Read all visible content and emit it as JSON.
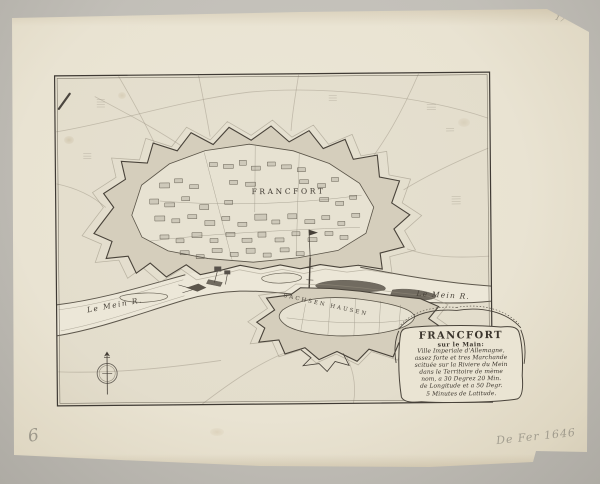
{
  "photo": {
    "backdrop_color": "#c2bfb8",
    "paper_color": "#e9e3d2",
    "ink_color": "#453f37"
  },
  "map": {
    "city_label": "FRANCFORT",
    "suburb_label": "SACHSEN HAUSEN",
    "river_label_left": "Le Mein R.",
    "river_label_right": "Le Mein R."
  },
  "cartouche": {
    "title": "FRANCFORT",
    "subtitle": "sur le Main:",
    "lines": [
      "Ville Imperiale d'Allemagne,",
      "assez forte et tres Marchande",
      "scituée sur la Riviere du Mein",
      "dans le Territoire de mème",
      "nom, a 30 Degrez 20 Min.",
      "de Longitude et a 50 Degr.",
      "5 Minutes de Latitude."
    ]
  },
  "icons": {
    "compass": "compass-rose"
  },
  "annotations": {
    "bottom_left_number": "6",
    "bottom_right_note": "De Fer 1646",
    "top_right_note": "17"
  }
}
